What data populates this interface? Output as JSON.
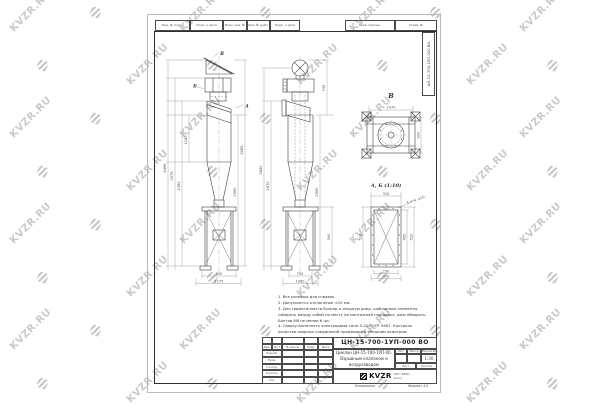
{
  "watermark": {
    "text": "KVZR.RU",
    "color": "#cacaca"
  },
  "sheet": {
    "top_stamp_left": [
      "Инв. № подл.",
      "Подп. и дата",
      "Взам. инв. №",
      "Инв. № дубл.",
      "Подп. и дата"
    ],
    "top_stamp_right": [
      "Перв. примен.",
      "Справ. №"
    ],
    "margin_designation": "ЦН-15-700-1УП-000 ВО"
  },
  "views": {
    "front_label_a": "А",
    "front_label_b": "Б",
    "top_view_label": "В",
    "flange_view_label": "А, Б (1:10)",
    "flange_note": "5 отв. ⌀10"
  },
  "dims": [
    {
      "x": 166,
      "y": 168,
      "t": "4465",
      "r": -90
    },
    {
      "x": 173,
      "y": 176,
      "t": "3575",
      "r": -90
    },
    {
      "x": 180,
      "y": 186,
      "t": "2380",
      "r": -90
    },
    {
      "x": 187,
      "y": 140,
      "t": "1180",
      "r": -90
    },
    {
      "x": 236,
      "y": 192,
      "t": "2960",
      "r": -90
    },
    {
      "x": 243,
      "y": 150,
      "t": "4085",
      "r": -90
    },
    {
      "x": 219,
      "y": 274.8,
      "t": "850",
      "r": 0
    },
    {
      "x": 219,
      "y": 282.4,
      "t": "1175",
      "r": 0
    },
    {
      "x": 262,
      "y": 170,
      "t": "3840",
      "r": -90
    },
    {
      "x": 269,
      "y": 186,
      "t": "2670",
      "r": -90
    },
    {
      "x": 318,
      "y": 192,
      "t": "2960",
      "r": -90
    },
    {
      "x": 325,
      "y": 88,
      "t": "795",
      "r": -90
    },
    {
      "x": 330,
      "y": 237,
      "t": "590",
      "r": -90
    },
    {
      "x": 300,
      "y": 274.8,
      "t": "790",
      "r": 0
    },
    {
      "x": 300,
      "y": 282.4,
      "t": "1060",
      "r": 0
    },
    {
      "x": 391,
      "y": 108.5,
      "t": "1470",
      "r": 0
    },
    {
      "x": 419.5,
      "y": 135,
      "t": "900",
      "r": -90
    },
    {
      "x": 386,
      "y": 194.8,
      "t": "310",
      "r": 0
    },
    {
      "x": 361.5,
      "y": 237,
      "t": "510",
      "r": -90
    },
    {
      "x": 405.5,
      "y": 237,
      "t": "450",
      "r": -90
    },
    {
      "x": 412.5,
      "y": 237,
      "t": "510",
      "r": -90
    },
    {
      "x": 386,
      "y": 272.4,
      "t": "230",
      "r": 0
    },
    {
      "x": 386,
      "y": 277.6,
      "t": "310",
      "r": 0
    }
  ],
  "notes": {
    "items": [
      "1. Все размеры для справок.",
      "2. Допускается отклонение ±10 мм.",
      "3. Для герметичности бункер и опорную раму, шаблонные элементы собирать между собой по месту на монтажной площадке, швы обварить. Болтов М8 не менее 6 шт.",
      "4. Сварку выполнять электродами типа Э-42 ГОСТ 9467. Контроль качества сварных соединений производить внешним осмотром."
    ]
  },
  "title_block": {
    "designation": "ЦН-15-700-1УП-000 ВО",
    "name_line1": "Циклон ЦН-15-700-1УП-00.",
    "name_line2": "Взрывным клапаном и",
    "name_line3": "воздуховодом",
    "lit_header": "Лит.",
    "mass_header": "Масса",
    "scale_header": "Масштаб",
    "scale_value": "1:30",
    "sheet_header": "Лист",
    "sheets_header": "Листов",
    "change_cols": [
      "Изм.",
      "Лист",
      "№ докум.",
      "Подп.",
      "Дата"
    ],
    "sign_rows": [
      "Разраб.",
      "Пров.",
      "Т.контр.",
      "Н.контр.",
      "Утв."
    ],
    "logo_text": "KVZR",
    "logo_sub1": "ООО «КВЗР»",
    "logo_sub2": "kvzr.ru",
    "copied_label": "Копировал",
    "format_label": "Формат А3"
  }
}
